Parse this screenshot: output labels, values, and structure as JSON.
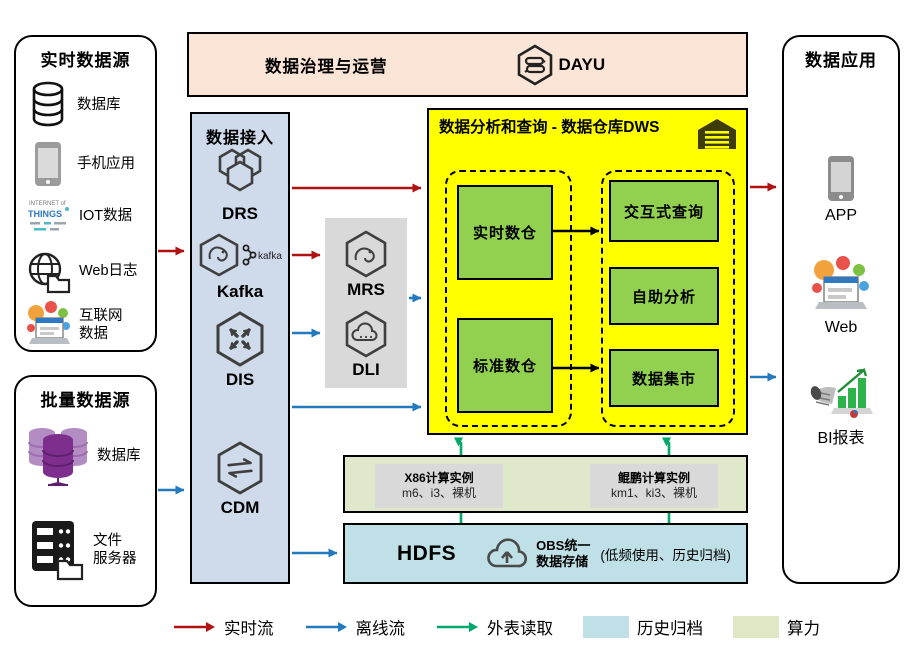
{
  "colors": {
    "realtime_flow": "#B01111",
    "offline_flow": "#2279BD",
    "external_read": "#00A86B",
    "archive_fill": "#BEE0E6",
    "compute_fill": "#E0E8CC",
    "dws_fill": "#FFFF00",
    "dws_node_fill": "#92D050",
    "banner_fill": "#FBE5D6",
    "ingest_fill": "#CFDAEB",
    "processing_fill": "#D9D9D9"
  },
  "banner": {
    "title": "数据治理与运营",
    "product": "DAYU"
  },
  "realtime_sources": {
    "title": "实时数据源",
    "items": [
      {
        "icon": "database-icon",
        "label": "数据库"
      },
      {
        "icon": "phone-icon",
        "label": "手机应用"
      },
      {
        "icon": "iot-icon",
        "label": "IOT数据"
      },
      {
        "icon": "weblog-icon",
        "label": "Web日志"
      },
      {
        "icon": "internet-icon",
        "label": "互联网\n数据"
      }
    ]
  },
  "batch_sources": {
    "title": "批量数据源",
    "items": [
      {
        "icon": "database-cluster-icon",
        "label": "数据库"
      },
      {
        "icon": "file-server-icon",
        "label": "文件\n服务器"
      }
    ]
  },
  "ingest": {
    "title": "数据接入",
    "items": [
      {
        "label": "DRS"
      },
      {
        "label": "Kafka",
        "badge": "kafka"
      },
      {
        "label": "DIS"
      },
      {
        "label": "CDM"
      }
    ]
  },
  "processing": {
    "items": [
      {
        "label": "MRS"
      },
      {
        "label": "DLI"
      }
    ]
  },
  "dws": {
    "title": "数据分析和查询 - 数据仓库DWS",
    "warehouses": [
      {
        "label": "实时数仓"
      },
      {
        "label": "标准数仓"
      }
    ],
    "services": [
      {
        "label": "交互式查询"
      },
      {
        "label": "自助分析"
      },
      {
        "label": "数据集市"
      }
    ]
  },
  "compute": {
    "instances": [
      {
        "title": "X86计算实例",
        "detail": "m6、i3、裸机"
      },
      {
        "title": "鲲鹏计算实例",
        "detail": "km1、ki3、裸机"
      }
    ]
  },
  "storage": {
    "hdfs_label": "HDFS",
    "obs_label": "OBS统一\n数据存储",
    "note": "(低频使用、历史归档)"
  },
  "apps": {
    "title": "数据应用",
    "items": [
      {
        "label": "APP"
      },
      {
        "label": "Web"
      },
      {
        "label": "BI报表"
      }
    ]
  },
  "iot_icon_text": {
    "line1": "INTERNET of",
    "line2": "THINGS"
  },
  "legend": {
    "items": [
      {
        "label": "实时流",
        "marker": "arrow-red"
      },
      {
        "label": "离线流",
        "marker": "arrow-blue"
      },
      {
        "label": "外表读取",
        "marker": "arrow-green"
      },
      {
        "label": "历史归档",
        "marker": "swatch-blue"
      },
      {
        "label": "算力",
        "marker": "swatch-green"
      }
    ]
  }
}
